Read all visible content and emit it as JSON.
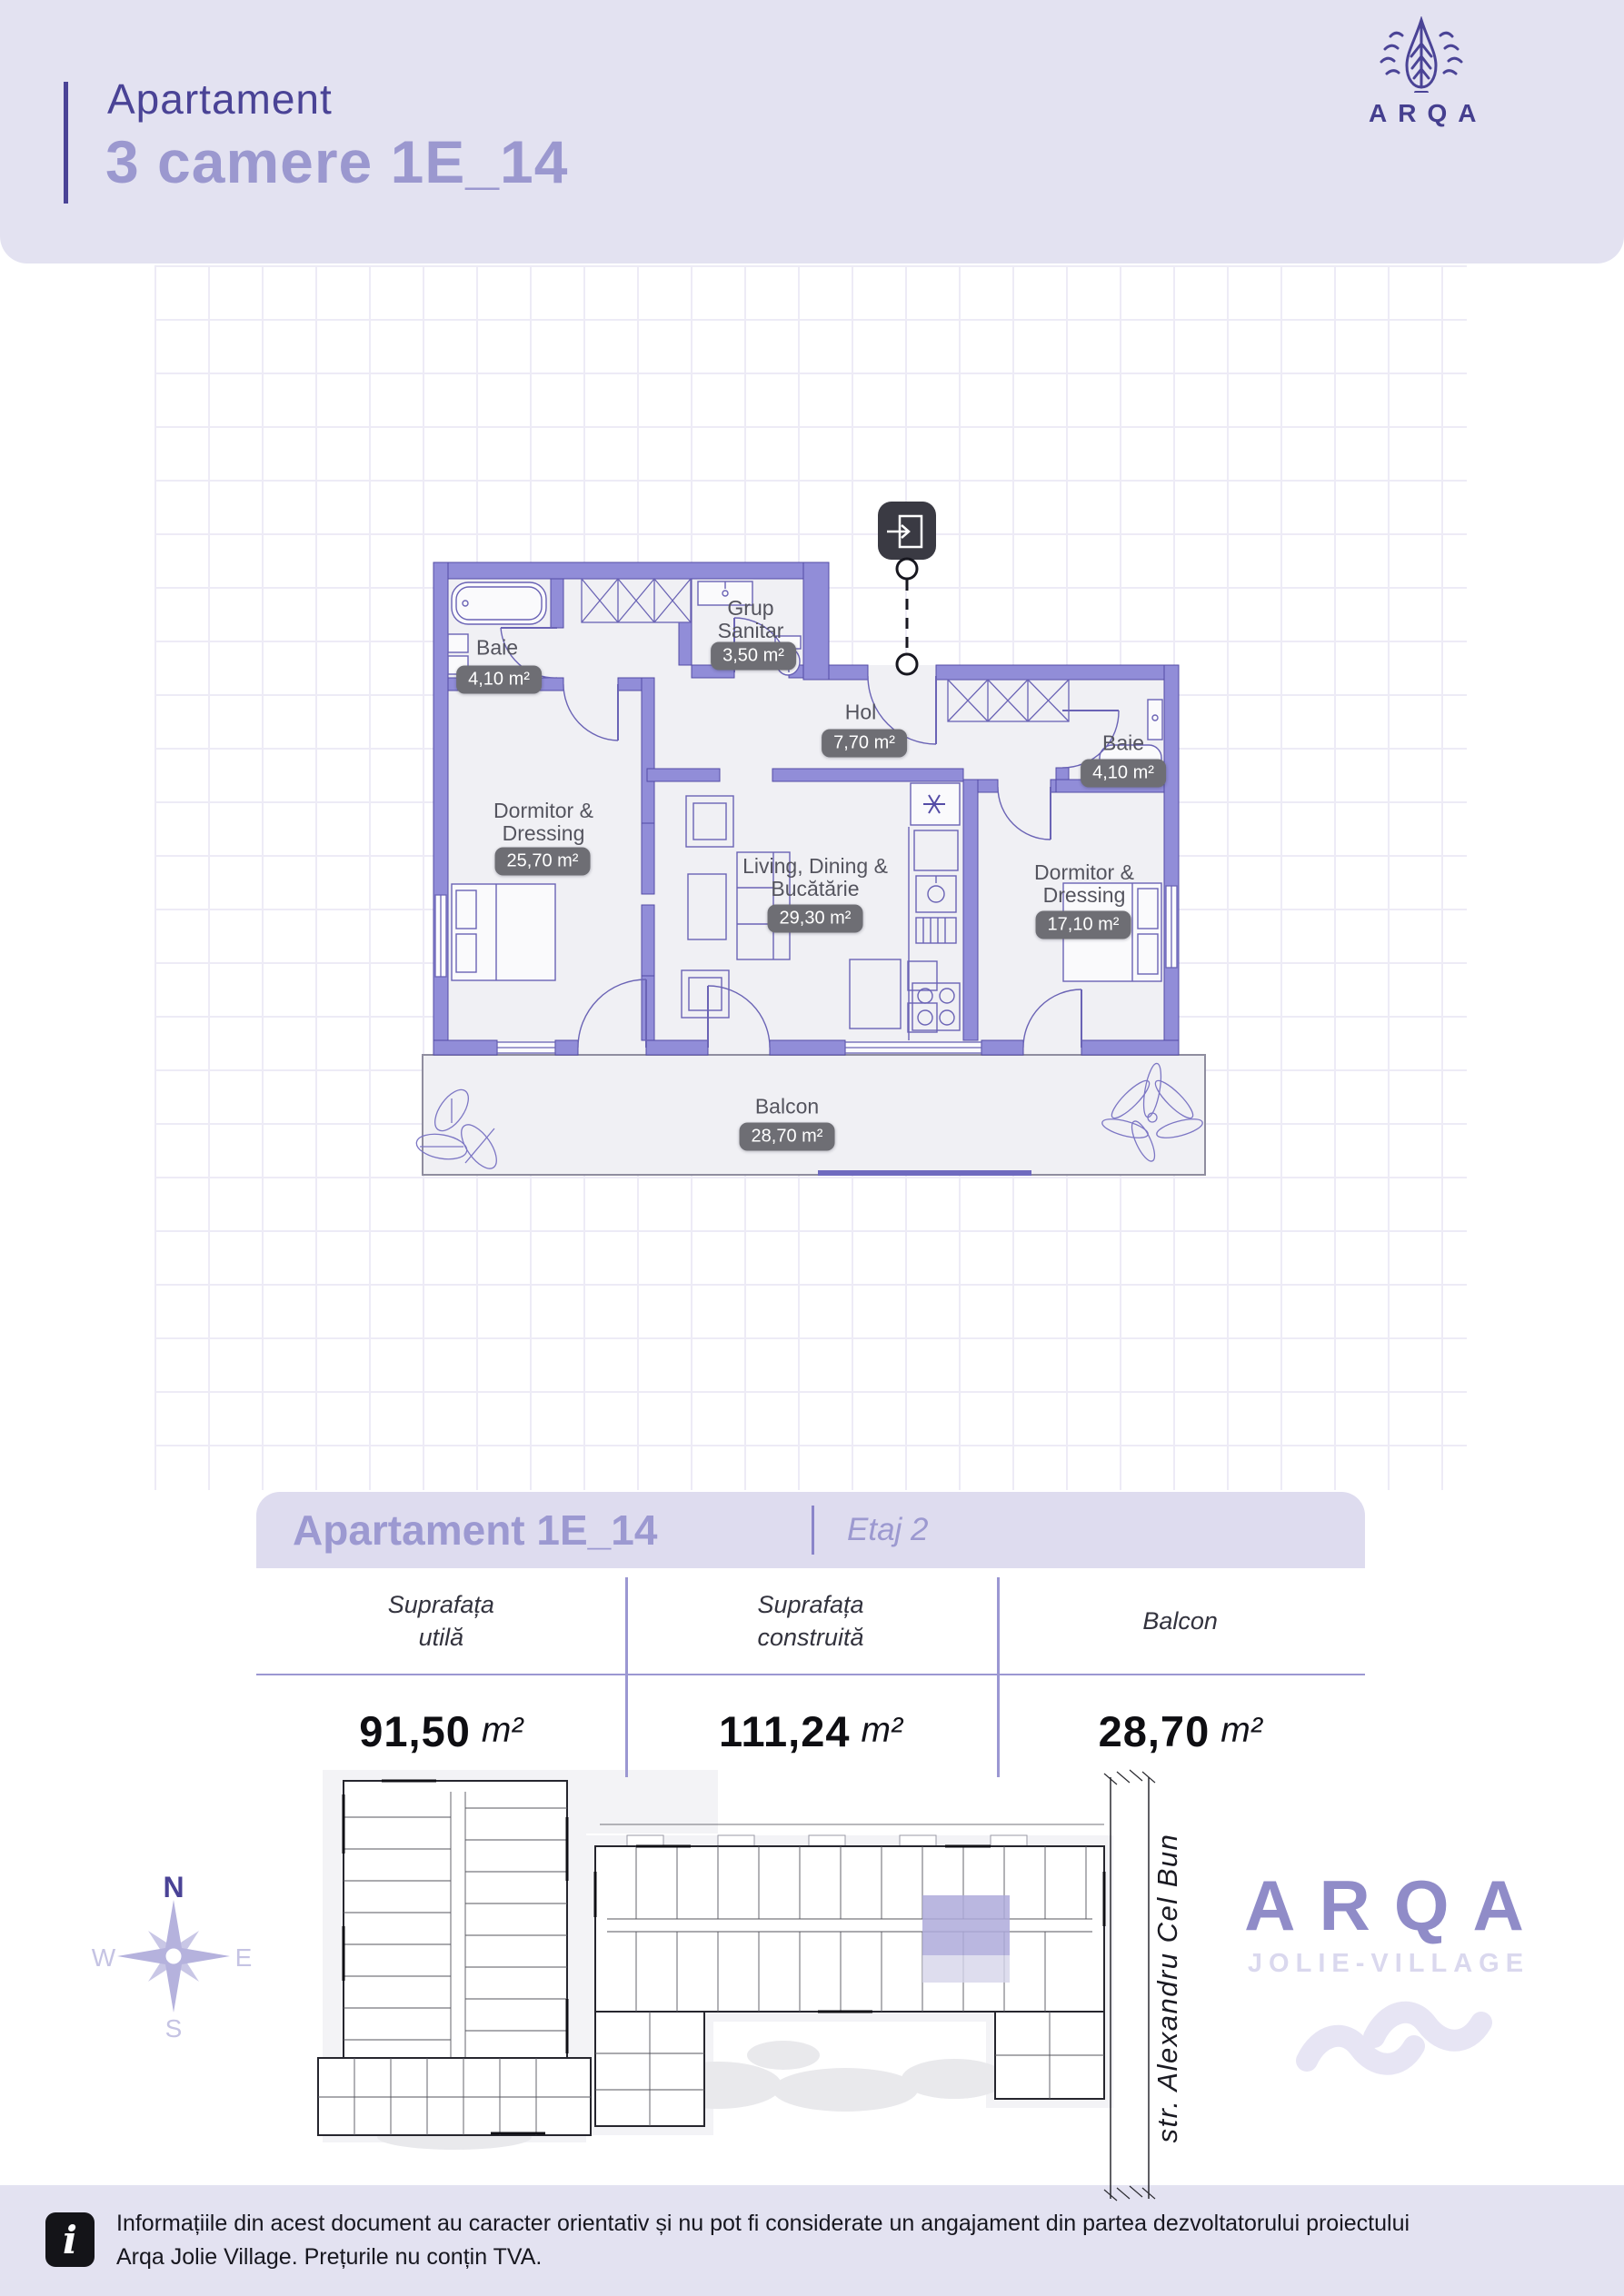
{
  "header": {
    "kicker": "Apartament",
    "title": "3 camere 1E_14",
    "brand": "ARQA"
  },
  "floor_plan": {
    "rooms": [
      {
        "line1": "Baie",
        "line2": "",
        "area": "4,10 m²"
      },
      {
        "line1": "Grup",
        "line2": "Sanitar",
        "area": "3,50 m²"
      },
      {
        "line1": "Hol",
        "line2": "",
        "area": "7,70 m²"
      },
      {
        "line1": "Dormitor &",
        "line2": "Dressing",
        "area": "25,70 m²"
      },
      {
        "line1": "Living, Dining &",
        "line2": "Bucătărie",
        "area": "29,30 m²"
      },
      {
        "line1": "Baie",
        "line2": "",
        "area": "4,10 m²"
      },
      {
        "line1": "Dormitor &",
        "line2": "Dressing",
        "area": "17,10 m²"
      },
      {
        "line1": "Balcon",
        "line2": "",
        "area": "28,70 m²"
      }
    ]
  },
  "summary_card": {
    "title": "Apartament 1E_14",
    "floor": "Etaj 2",
    "columns": [
      {
        "label_line1": "Suprafața",
        "label_line2": "utilă",
        "value": "91,50",
        "unit": "m²"
      },
      {
        "label_line1": "Suprafața",
        "label_line2": "construită",
        "value": "111,24",
        "unit": "m²"
      },
      {
        "label_line1": "Balcon",
        "label_line2": "",
        "value": "28,70",
        "unit": "m²"
      }
    ]
  },
  "site_plan": {
    "compass": {
      "n": "N",
      "e": "E",
      "s": "S",
      "w": "W"
    },
    "street": "str. Alexandru Cel Bun",
    "brand": "ARQA",
    "brand_sub": "JOLIE-VILLAGE"
  },
  "footer": {
    "icon": "i",
    "line1": "Informațiile din acest document au caracter orientativ și nu pot fi considerate un angajament din partea dezvoltatorului proiectului",
    "line2": "Arqa Jolie Village. Prețurile nu conțin TVA."
  },
  "colors": {
    "accent_dark": "#4A4396",
    "accent_light": "#9B98CF",
    "wall": "#918DD8",
    "band": "#E3E2F1",
    "badge": "#6E6E74",
    "highlight_unit": "#AEAADA"
  }
}
